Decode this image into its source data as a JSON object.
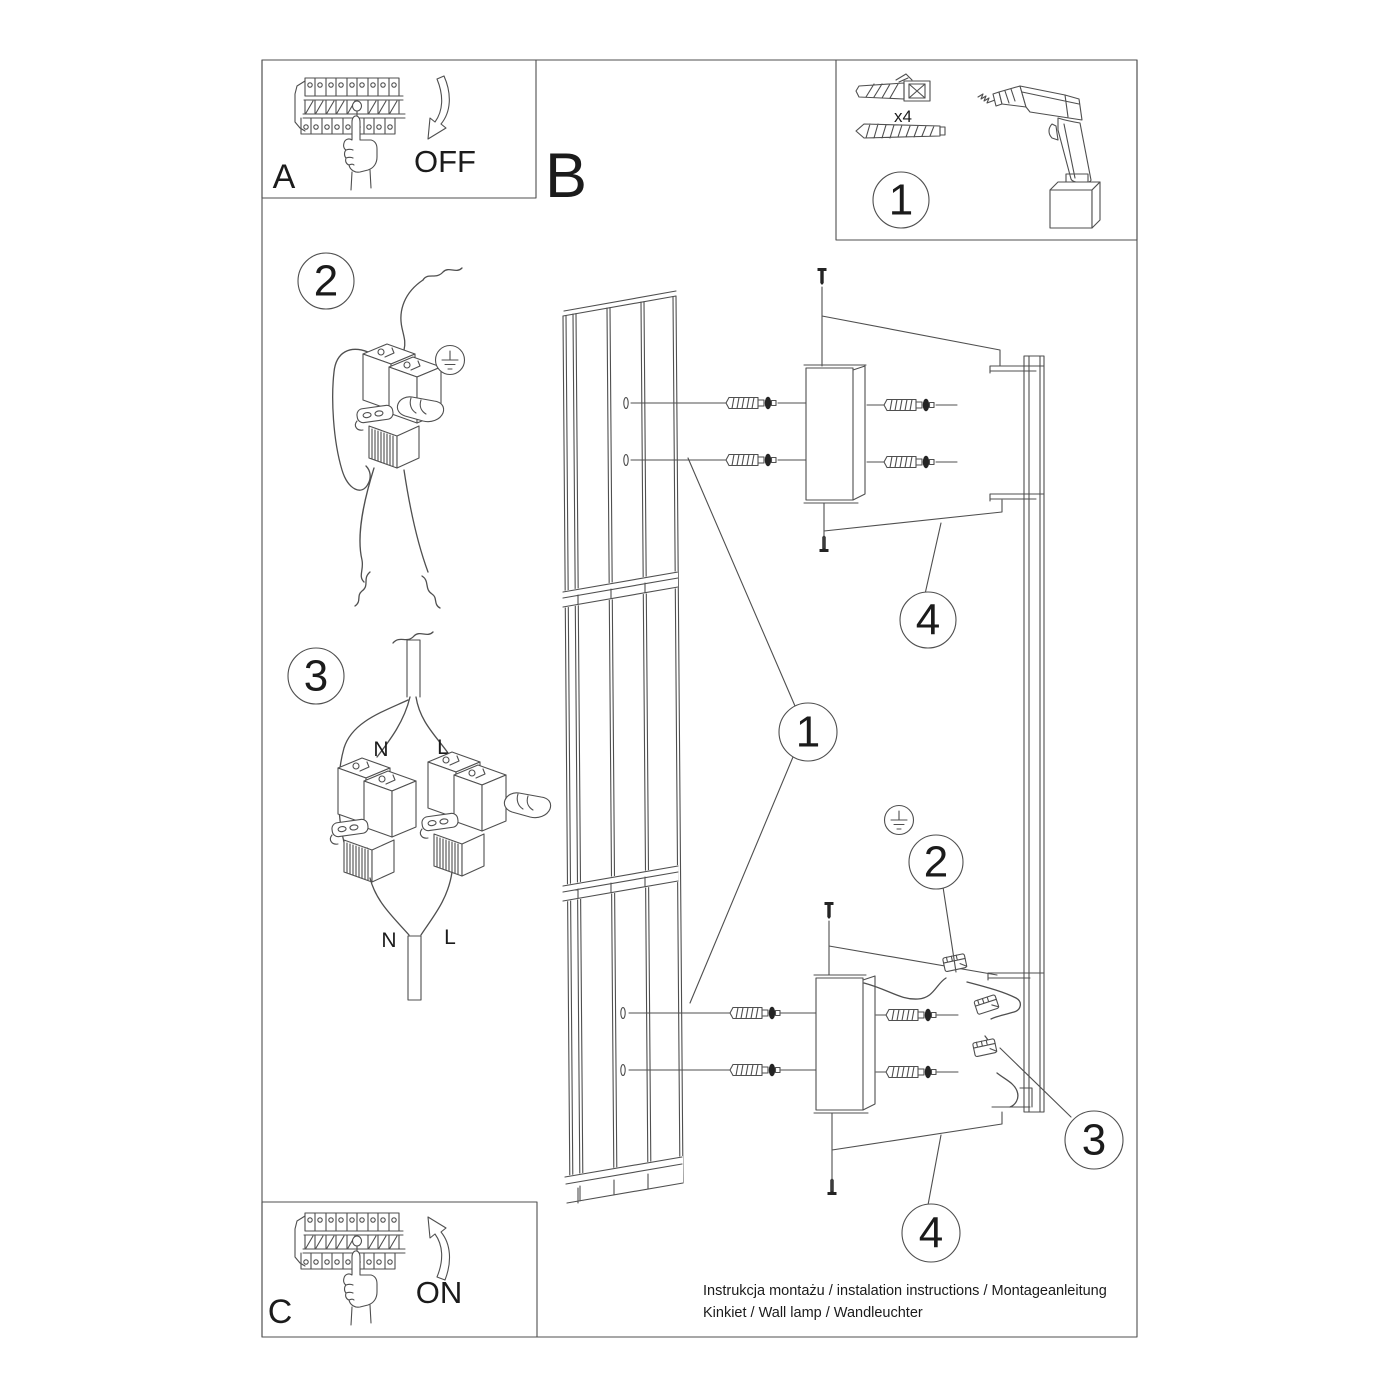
{
  "panel_off": {
    "label": "A",
    "action": "OFF"
  },
  "panel_main": {
    "label": "B"
  },
  "panel_tools": {
    "step": "1",
    "anchors_count": "x4"
  },
  "step_ground": {
    "number": "2"
  },
  "step_wiring": {
    "number": "3",
    "labels": {
      "top_n": "N",
      "top_l": "L",
      "bottom_n": "N",
      "bottom_l": "L"
    }
  },
  "panel_on": {
    "label": "C",
    "action": "ON"
  },
  "assembly_callouts": {
    "lamp_body": "1",
    "wall_bracket_top": "4",
    "ground_terminal": "2",
    "wire_connector": "3",
    "wall_bracket_bottom": "4"
  },
  "footer": {
    "line1": "Instrukcja montażu / instalation instructions / Montageanleitung",
    "line2": "Kinkiet / Wall lamp / Wandleuchter"
  }
}
